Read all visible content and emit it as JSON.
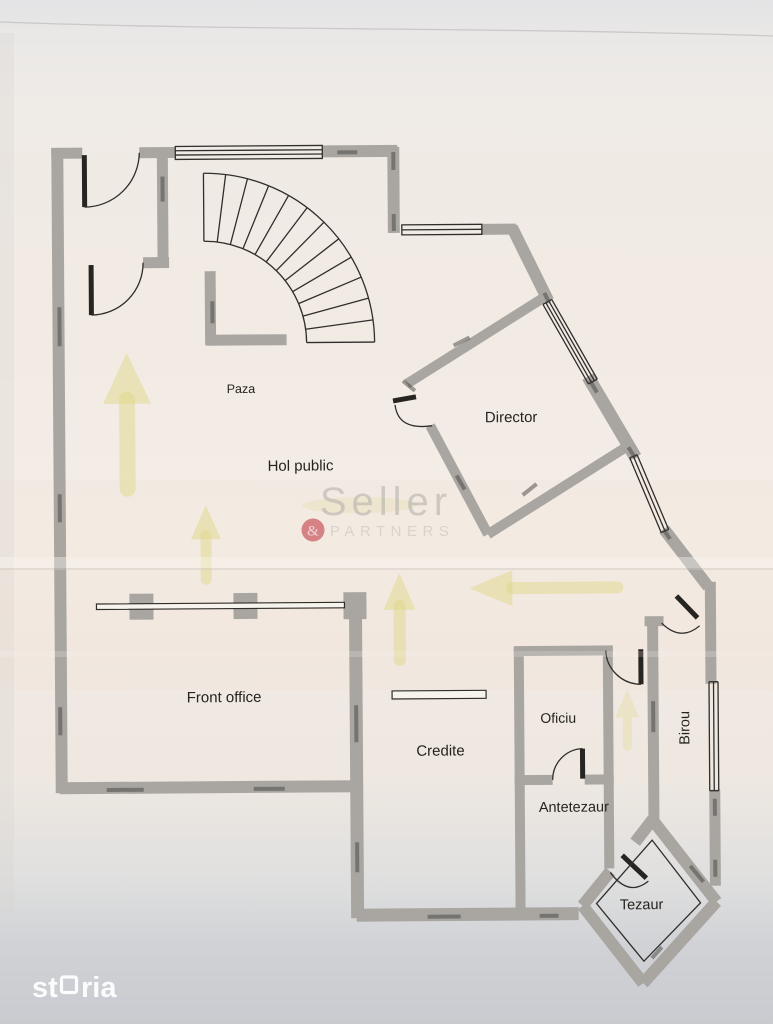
{
  "rooms": {
    "paza": "Paza",
    "hol_public": "Hol public",
    "director": "Director",
    "front_office": "Front office",
    "credite": "Credite",
    "oficiu": "Oficiu",
    "antetezaur": "Antetezaur",
    "birou": "Birou",
    "tezaur": "Tezaur"
  },
  "watermark": {
    "brand": "Seller",
    "ampersand": "&",
    "subtitle": "PARTNERS"
  },
  "site_logo": {
    "full": "storia",
    "part1": "st",
    "part2": "ria"
  },
  "annotations": {
    "highlight_arrows": [
      "up - entrance hall left",
      "up - entrance hall center",
      "up - hall mid",
      "left - from Birou corridor into hall",
      "up - corridor to Tezaur"
    ],
    "highlight_color": "#e0d88a"
  },
  "colors": {
    "wall": "#a9a6a2",
    "ink": "#302e2b",
    "paper": "#f3ece5",
    "top_shade": "#e4e4e6",
    "bottom_shade": "#c9cbd0",
    "watermark_red": "#c9545c",
    "logo_white": "#fcfcfd"
  }
}
